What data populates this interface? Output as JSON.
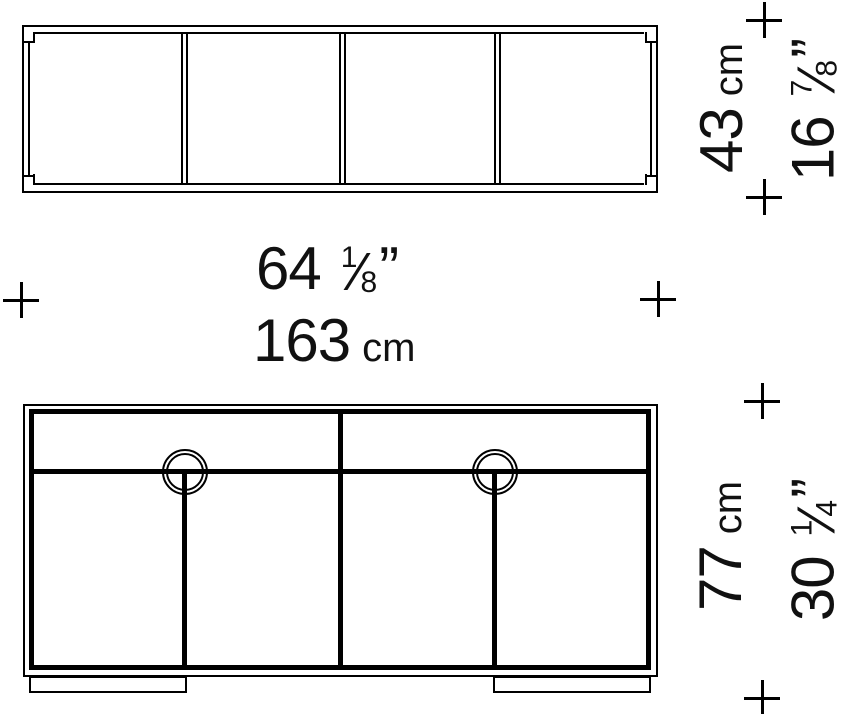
{
  "drawing": {
    "kind": "sideboard dimension diagram",
    "top_view": {
      "panel_count": 4
    },
    "front_view": {
      "drawer_count": 2,
      "door_count": 4,
      "handle_count": 2,
      "foot_count": 2
    },
    "labels": {
      "width_in": {
        "value": "64",
        "frac_num": "1",
        "frac_slash": "⁄",
        "frac_den": "8",
        "inch_mark": "”"
      },
      "width_cm": {
        "value": "163",
        "unit": "cm"
      },
      "depth_cm": {
        "value": "43",
        "unit": "cm"
      },
      "depth_in": {
        "value": "16",
        "frac_num": "7",
        "frac_slash": "⁄",
        "frac_den": "8",
        "inch_mark": "”"
      },
      "height_cm": {
        "value": "77",
        "unit": "cm"
      },
      "height_in": {
        "value": "30",
        "frac_num": "1",
        "frac_slash": "⁄",
        "frac_den": "4",
        "inch_mark": "”"
      }
    },
    "colors": {
      "line": "#000000",
      "text": "#111111",
      "background": "#ffffff"
    }
  }
}
